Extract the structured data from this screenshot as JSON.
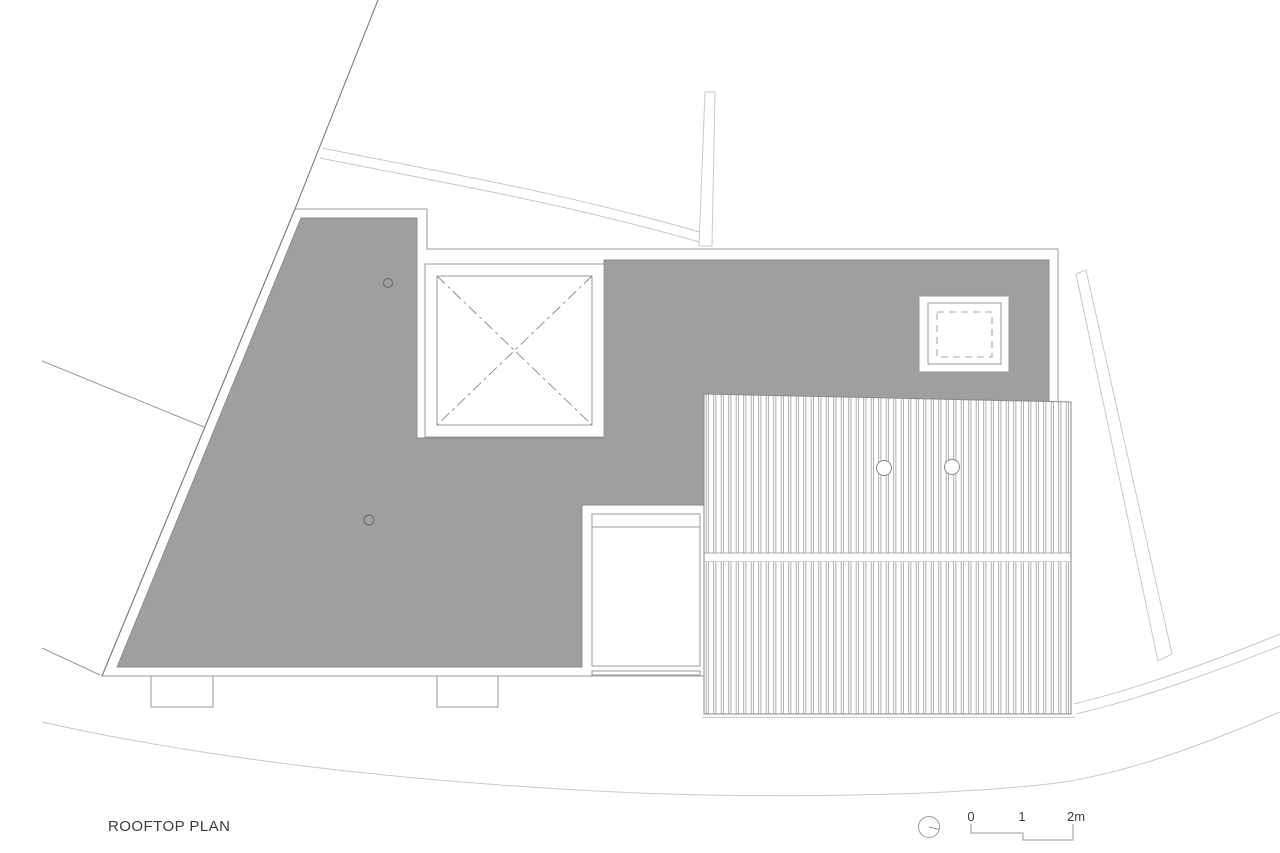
{
  "title": {
    "label": "ROOFTOP PLAN"
  },
  "scale_bar": {
    "labels": [
      "0",
      "1",
      "2m"
    ]
  },
  "colors": {
    "roof_fill": "#9f9f9f",
    "roof_outline": "#8a8a8a",
    "building_line": "#9a9a9a",
    "boundary_line": "#7f7f7f",
    "site_line": "#c9c9c9",
    "rib_line": "#a6a6a6",
    "text_color": "#3e3e3e"
  }
}
